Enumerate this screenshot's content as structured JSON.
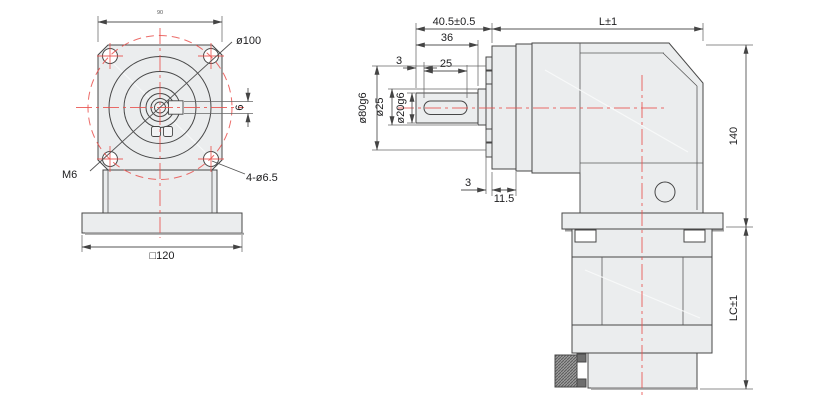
{
  "drawing": {
    "front_view": {
      "flange_width": "90",
      "bolt_circle": "ø100",
      "tap_label": "M6",
      "holes_label": "4-ø6.5",
      "key_width": "6",
      "base_width": "□120"
    },
    "side_view": {
      "shaft_assembly_length": "40.5±0.5",
      "body_length": "L±1",
      "shaft_length": "36",
      "key_offset": "3",
      "key_length": "25",
      "shaft_dia": "ø20g6",
      "boss_dia": "ø25",
      "pilot_dia": "ø80g6",
      "pilot_depth": "3",
      "flange_thickness": "11.5",
      "body_height": "140",
      "motor_length": "LC±1"
    },
    "colors": {
      "centerline": "#e9514d",
      "outline": "#474747",
      "fill": "#ebedee"
    }
  }
}
